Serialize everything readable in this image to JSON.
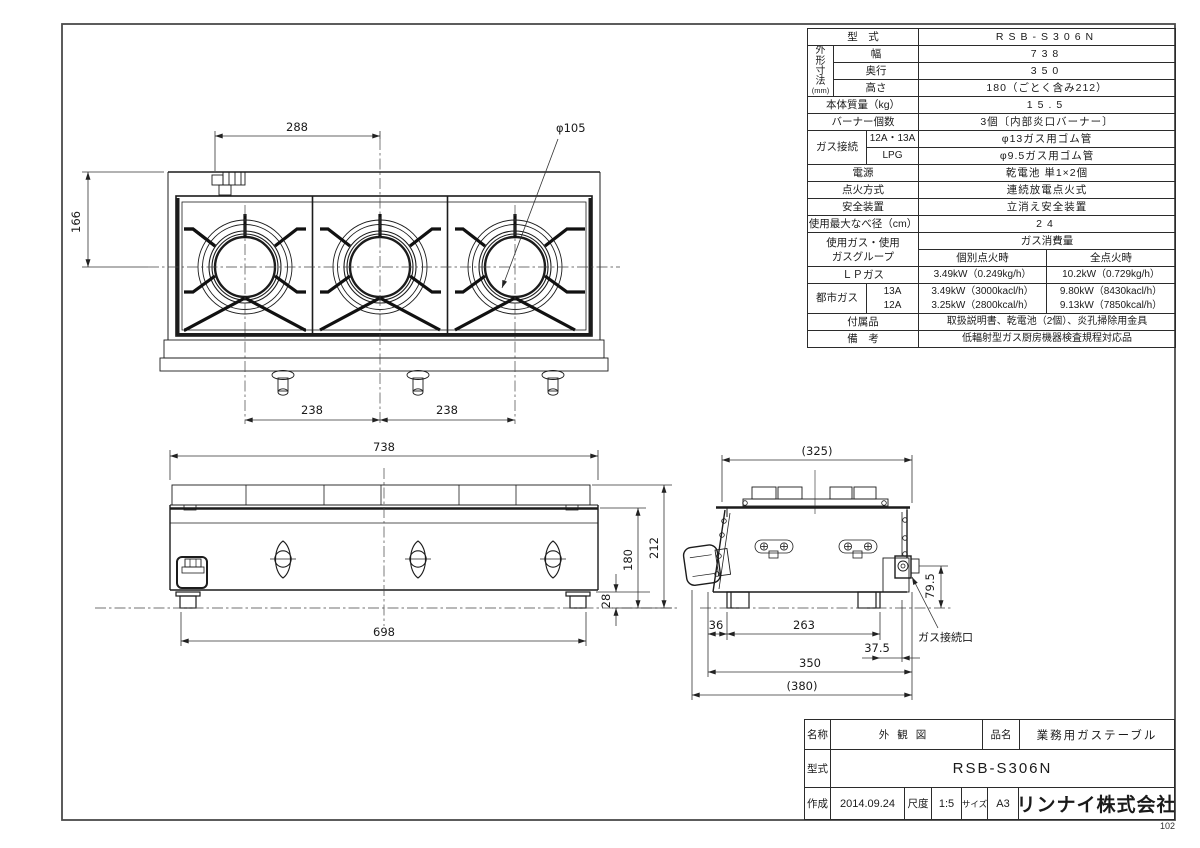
{
  "page": {
    "sheet_number": "102"
  },
  "spec": {
    "model_label": "型　式",
    "model_value": "RSB-S306N",
    "dims_group": "外形寸法",
    "dims_unit": "(mm)",
    "width_label": "幅",
    "width_value": "738",
    "depth_label": "奥行",
    "depth_value": "350",
    "height_label": "高さ",
    "height_value": "180（ごとく含み212）",
    "weight_label": "本体質量（kg）",
    "weight_value": "15.5",
    "burners_label": "バーナー個数",
    "burners_value": "3個〔内部炎口バーナー〕",
    "gas_conn_label": "ガス接続",
    "gas_12a13a_label": "12A・13A",
    "gas_12a13a_value": "φ13ガス用ゴム管",
    "gas_lpg_label": "LPG",
    "gas_lpg_value": "φ9.5ガス用ゴム管",
    "power_label": "電源",
    "power_value": "乾電池 単1×2個",
    "ignition_label": "点火方式",
    "ignition_value": "連続放電点火式",
    "safety_label": "安全装置",
    "safety_value": "立消え安全装置",
    "pan_label": "使用最大なべ径（cm）",
    "pan_value": "24",
    "gas_group_line1": "使用ガス・使用",
    "gas_group_line2": "ガスグループ",
    "consumption_header": "ガス消費量",
    "individual_label": "個別点火時",
    "all_label": "全点火時",
    "lp_label": "ＬＰガス",
    "lp_individual": "3.49kW（0.249kg/h）",
    "lp_all": "10.2kW（0.729kg/h）",
    "city_label": "都市ガス",
    "city_13a_label": "13A",
    "city_12a_label": "12A",
    "city_13a_individual": "3.49kW（3000kacl/h）",
    "city_13a_all": "9.80kW（8430kacl/h）",
    "city_12a_individual": "3.25kW（2800kcal/h）",
    "city_12a_all": "9.13kW（7850kcal/h）",
    "accessories_label": "付属品",
    "accessories_value": "取扱説明書、乾電池（2個）、炎孔掃除用金具",
    "remarks_label": "備　考",
    "remarks_value": "低輻射型ガス厨房機器検査規程対応品"
  },
  "title_block": {
    "name_label": "名称",
    "name_value": "外観図",
    "product_label": "品名",
    "product_value": "業務用ガステーブル",
    "model_label": "型式",
    "model_value": "RSB-S306N",
    "date_label": "作成",
    "date_value": "2014.09.24",
    "scale_label": "尺度",
    "scale_value": "1:5",
    "size_label": "サイズ",
    "size_value": "A3",
    "company": "リンナイ株式会社"
  },
  "dims": {
    "top_view": {
      "w288": "288",
      "burner_dia": "φ105",
      "d166": "166",
      "p238l": "238",
      "p238r": "238"
    },
    "front_view": {
      "w738": "738",
      "h180": "180",
      "h212": "212",
      "foot28": "28",
      "w698": "698"
    },
    "side_view": {
      "w325": "(325)",
      "gas_h": "79.5",
      "f36": "36",
      "f263": "263",
      "f375": "37.5",
      "d350": "350",
      "d380": "(380)",
      "gas_label": "ガス接続口"
    }
  }
}
